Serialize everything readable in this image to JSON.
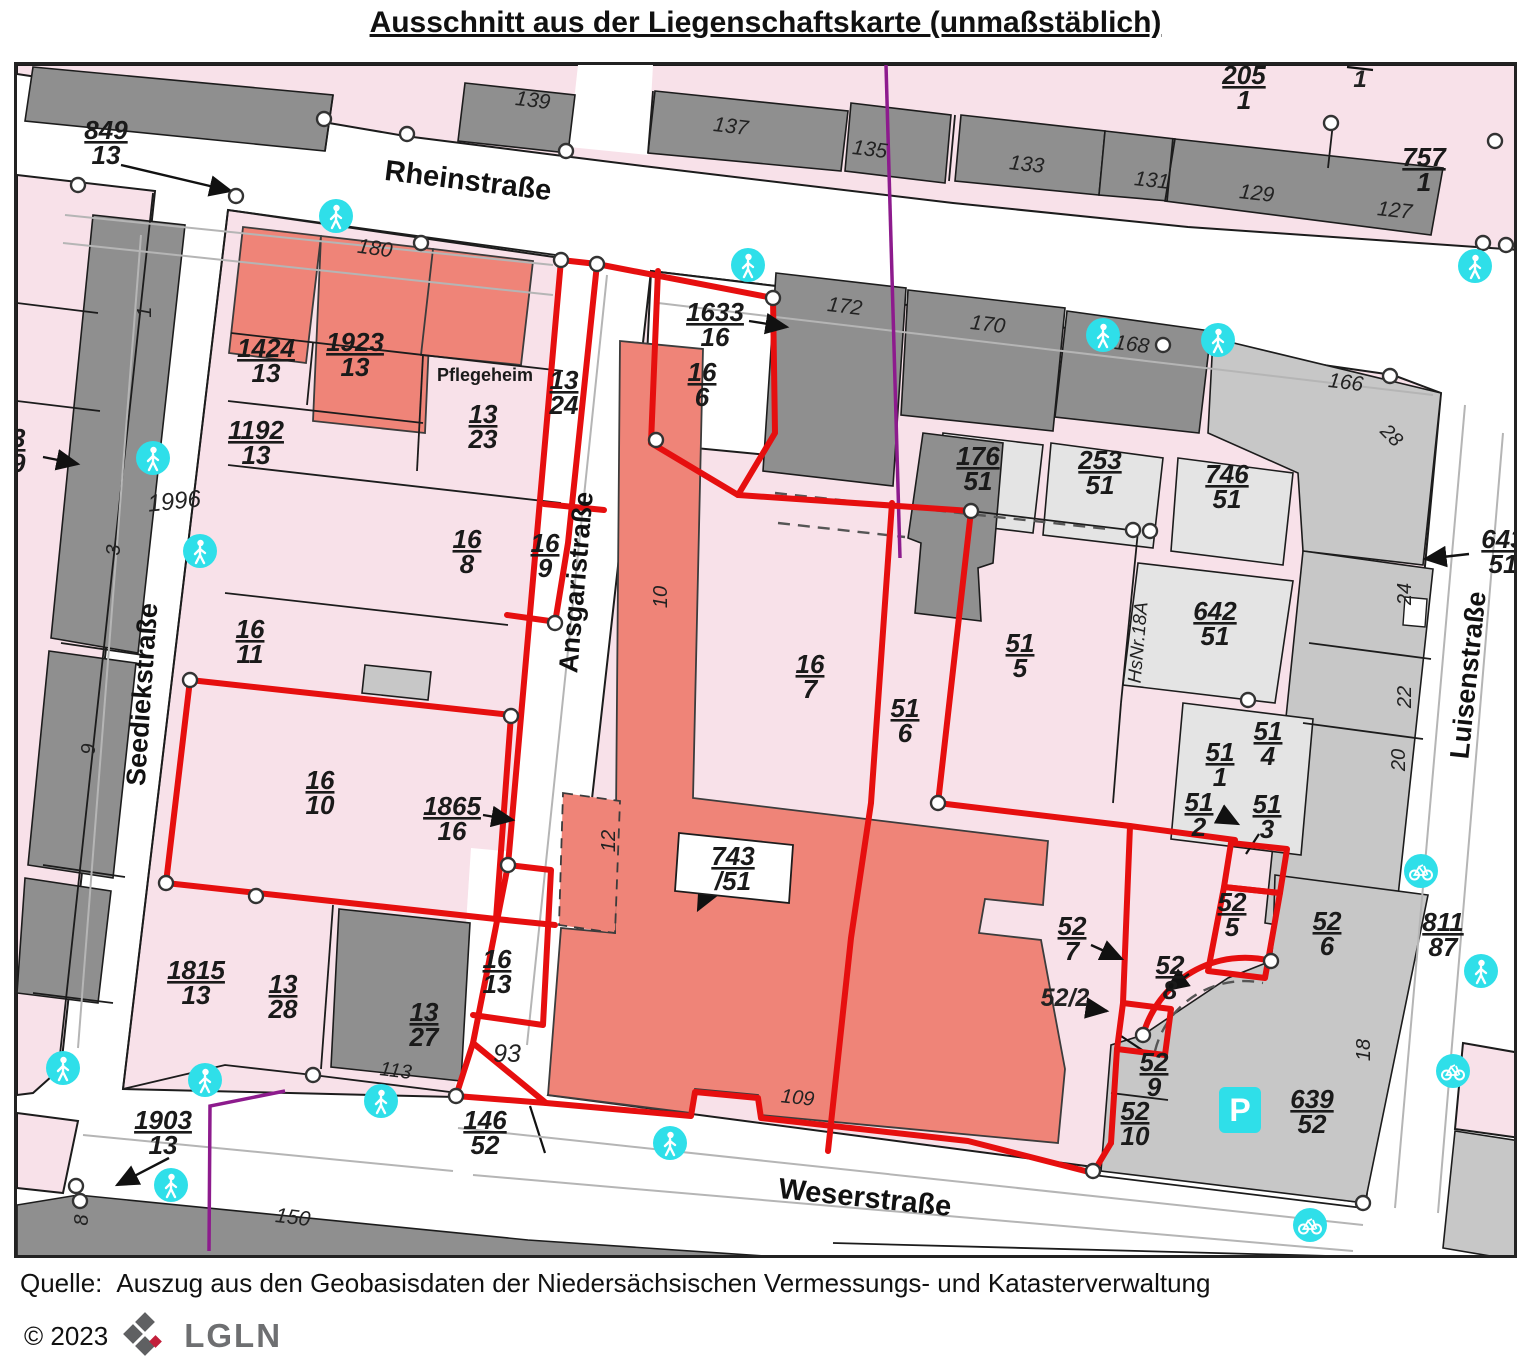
{
  "title": "Ausschnitt aus der Liegenschaftskarte (unmaßstäblich)",
  "footer": {
    "quelle_label": "Quelle:",
    "source_text": "Auszug aus den Geobasisdaten der Niedersächsischen Vermessungs- und Katasterverwaltung",
    "copyright": "© 2023",
    "logo_text": "LGLN"
  },
  "colors": {
    "parcel_pink": "#f8e1e9",
    "building_salmon": "#ef8478",
    "building_gray": "#8f8f8f",
    "parcel_light_gray": "#e4e4e4",
    "parcel_mid_gray": "#c7c7c7",
    "boundary_red": "#e60f0f",
    "line_purple": "#8d1b8d",
    "icon_cyan": "#2fdfe9",
    "text_dark": "#1a1a1a"
  },
  "map": {
    "streets": [
      {
        "name": "Rheinstraße",
        "x": 464,
        "y": 187,
        "rot": 7,
        "size": 29
      },
      {
        "name": "Seediekstraße",
        "x": 148,
        "y": 692,
        "rot": -86,
        "size": 27
      },
      {
        "name": "Ansgaristraße",
        "x": 582,
        "y": 580,
        "rot": -85,
        "size": 27
      },
      {
        "name": "Luisenstraße",
        "x": 1474,
        "y": 673,
        "rot": -84,
        "size": 27
      },
      {
        "name": "Weserstraße",
        "x": 861,
        "y": 1204,
        "rot": 6,
        "size": 29
      }
    ],
    "fractions": [
      {
        "n": "849",
        "d": "13",
        "x": 103,
        "y": 140
      },
      {
        "n": "205",
        "d": "1",
        "x": 1241,
        "y": 85
      },
      {
        "n": "757",
        "d": "1",
        "x": 1421,
        "y": 167
      },
      {
        "n": "1424",
        "d": "13",
        "x": 263,
        "y": 358
      },
      {
        "n": "1923",
        "d": "13",
        "x": 352,
        "y": 352
      },
      {
        "n": "13",
        "d": "24",
        "x": 561,
        "y": 390
      },
      {
        "n": "1633",
        "d": "16",
        "x": 712,
        "y": 322
      },
      {
        "n": "16",
        "d": "6",
        "x": 699,
        "y": 382
      },
      {
        "n": "1192",
        "d": "13",
        "x": 253,
        "y": 440
      },
      {
        "n": "13",
        "d": "23",
        "x": 480,
        "y": 424
      },
      {
        "n": "176",
        "d": "51",
        "x": 975,
        "y": 466
      },
      {
        "n": "253",
        "d": "51",
        "x": 1097,
        "y": 470
      },
      {
        "n": "746",
        "d": "51",
        "x": 1224,
        "y": 484
      },
      {
        "n": "643",
        "d": "51",
        "x": 1500,
        "y": 549
      },
      {
        "n": "16",
        "d": "8",
        "x": 464,
        "y": 549
      },
      {
        "n": "16",
        "d": "9",
        "x": 542,
        "y": 553
      },
      {
        "n": "642",
        "d": "51",
        "x": 1212,
        "y": 621
      },
      {
        "n": "16",
        "d": "11",
        "x": 247,
        "y": 639
      },
      {
        "n": "51",
        "d": "5",
        "x": 1017,
        "y": 653
      },
      {
        "n": "16",
        "d": "7",
        "x": 807,
        "y": 674
      },
      {
        "n": "51",
        "d": "6",
        "x": 902,
        "y": 718
      },
      {
        "n": "16",
        "d": "10",
        "x": 317,
        "y": 790
      },
      {
        "n": "1865",
        "d": "16",
        "x": 449,
        "y": 816
      },
      {
        "n": "743",
        "d": "/51",
        "x": 730,
        "y": 866
      },
      {
        "n": "51",
        "d": "1",
        "x": 1217,
        "y": 762
      },
      {
        "n": "51",
        "d": "4",
        "x": 1265,
        "y": 741
      },
      {
        "n": "51",
        "d": "2",
        "x": 1196,
        "y": 812
      },
      {
        "n": "51",
        "d": "3",
        "x": 1264,
        "y": 814
      },
      {
        "n": "52",
        "d": "7",
        "x": 1069,
        "y": 936
      },
      {
        "n": "52",
        "d": "8",
        "x": 1167,
        "y": 975
      },
      {
        "n": "52",
        "d": "5",
        "x": 1229,
        "y": 912
      },
      {
        "n": "52",
        "d": "6",
        "x": 1324,
        "y": 931
      },
      {
        "n": "811",
        "d": "87",
        "x": 1440,
        "y": 932
      },
      {
        "n": "52",
        "d": "9",
        "x": 1151,
        "y": 1072
      },
      {
        "n": "52",
        "d": "10",
        "x": 1132,
        "y": 1121
      },
      {
        "n": "639",
        "d": "52",
        "x": 1309,
        "y": 1109
      },
      {
        "n": "1815",
        "d": "13",
        "x": 193,
        "y": 980
      },
      {
        "n": "13",
        "d": "28",
        "x": 280,
        "y": 994
      },
      {
        "n": "13",
        "d": "27",
        "x": 421,
        "y": 1022
      },
      {
        "n": "16",
        "d": "13",
        "x": 494,
        "y": 969
      },
      {
        "n": "146",
        "d": "52",
        "x": 482,
        "y": 1130
      },
      {
        "n": "1903",
        "d": "13",
        "x": 160,
        "y": 1130
      },
      {
        "n": "13",
        "d": "19",
        "x": 8,
        "y": 448
      }
    ],
    "house_numbers": [
      {
        "t": "139",
        "x": 529,
        "y": 104,
        "r": 7,
        "s": 21
      },
      {
        "t": "137",
        "x": 727,
        "y": 130,
        "r": 7,
        "s": 21
      },
      {
        "t": "135",
        "x": 866,
        "y": 153,
        "r": 7,
        "s": 21
      },
      {
        "t": "133",
        "x": 1023,
        "y": 168,
        "r": 6,
        "s": 21
      },
      {
        "t": "131",
        "x": 1148,
        "y": 184,
        "r": 6,
        "s": 21
      },
      {
        "t": "129",
        "x": 1253,
        "y": 197,
        "r": 6,
        "s": 21
      },
      {
        "t": "127",
        "x": 1391,
        "y": 214,
        "r": 6,
        "s": 21
      },
      {
        "t": "180",
        "x": 371,
        "y": 252,
        "r": 8,
        "s": 21
      },
      {
        "t": "172",
        "x": 841,
        "y": 310,
        "r": 7,
        "s": 21
      },
      {
        "t": "170",
        "x": 984,
        "y": 328,
        "r": 7,
        "s": 21
      },
      {
        "t": "168",
        "x": 1128,
        "y": 348,
        "r": 7,
        "s": 21
      },
      {
        "t": "166",
        "x": 1342,
        "y": 386,
        "r": 7,
        "s": 21
      },
      {
        "t": "1996",
        "x": 172,
        "y": 506,
        "r": -6,
        "s": 24
      },
      {
        "t": "93",
        "x": 504,
        "y": 1059,
        "r": 0,
        "s": 25
      },
      {
        "t": "113",
        "x": 392,
        "y": 1074,
        "r": 7,
        "s": 20
      },
      {
        "t": "109",
        "x": 794,
        "y": 1101,
        "r": 6,
        "s": 20
      },
      {
        "t": "150",
        "x": 289,
        "y": 1221,
        "r": 7,
        "s": 21
      },
      {
        "t": "52/2",
        "x": 1062,
        "y": 1003,
        "r": 0,
        "s": 25,
        "b": 1
      },
      {
        "t": "28",
        "x": 1384,
        "y": 437,
        "r": 45,
        "s": 20
      },
      {
        "t": "24",
        "x": 1408,
        "y": 591,
        "r": -90,
        "s": 20
      },
      {
        "t": "22",
        "x": 1408,
        "y": 694,
        "r": -90,
        "s": 20
      },
      {
        "t": "20",
        "x": 1402,
        "y": 757,
        "r": -90,
        "s": 20
      },
      {
        "t": "18",
        "x": 1367,
        "y": 1047,
        "r": -90,
        "s": 20
      },
      {
        "t": "10",
        "x": 664,
        "y": 594,
        "r": -90,
        "s": 20
      },
      {
        "t": "12",
        "x": 612,
        "y": 838,
        "r": -90,
        "s": 20
      },
      {
        "t": "1",
        "x": 148,
        "y": 309,
        "r": -90,
        "s": 20
      },
      {
        "t": "3",
        "x": 117,
        "y": 547,
        "r": -90,
        "s": 20
      },
      {
        "t": "9",
        "x": 92,
        "y": 746,
        "r": -90,
        "s": 20
      },
      {
        "t": "8",
        "x": 85,
        "y": 1217,
        "r": -90,
        "s": 20
      },
      {
        "t": "1",
        "x": 1357,
        "y": 84,
        "r": 0,
        "s": 24,
        "b": 1
      },
      {
        "t": "HsNr.18A",
        "x": 1141,
        "y": 640,
        "r": -85,
        "s": 19
      },
      {
        "t": "Pflegeheim",
        "x": 482,
        "y": 378,
        "r": 0,
        "s": 18,
        "cls": "pfl"
      }
    ],
    "icons": {
      "pedestrian": [
        {
          "x": 333,
          "y": 213
        },
        {
          "x": 745,
          "y": 262
        },
        {
          "x": 1100,
          "y": 332
        },
        {
          "x": 1215,
          "y": 337
        },
        {
          "x": 1472,
          "y": 263
        },
        {
          "x": 150,
          "y": 455
        },
        {
          "x": 197,
          "y": 548
        },
        {
          "x": 667,
          "y": 1140
        },
        {
          "x": 60,
          "y": 1065
        },
        {
          "x": 202,
          "y": 1077
        },
        {
          "x": 378,
          "y": 1098
        },
        {
          "x": 168,
          "y": 1182
        },
        {
          "x": 1478,
          "y": 968
        }
      ],
      "bike": [
        {
          "x": 1418,
          "y": 868
        },
        {
          "x": 1450,
          "y": 1068
        },
        {
          "x": 1307,
          "y": 1222
        }
      ],
      "parking": [
        {
          "x": 1237,
          "y": 1107
        }
      ]
    }
  }
}
